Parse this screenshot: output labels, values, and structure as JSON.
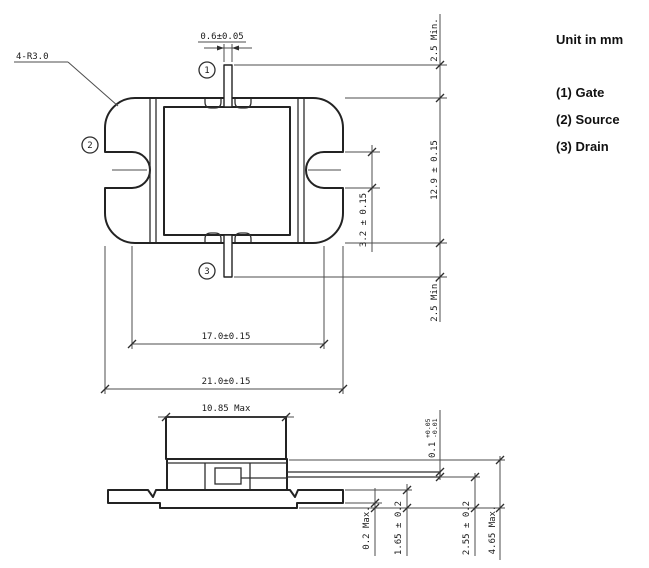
{
  "drawing": {
    "legend": {
      "unit_label": "Unit in mm",
      "pin_1": "(1) Gate",
      "pin_2": "(2) Source",
      "pin_3": "(3) Drain"
    },
    "markers": {
      "gate": "1",
      "source": "2",
      "drain": "3"
    },
    "top_view": {
      "corner_radius": "4-R3.0",
      "lead_width": "0.6±0.05",
      "gate_lead_min": "2.5 Min.",
      "body_height": "12.9 ± 0.15",
      "drain_lead_min": "2.5 Min.",
      "slot_width": "3.2 ± 0.15",
      "slot_pitch": "17.0±0.15",
      "body_width": "21.0±0.15"
    },
    "side_view": {
      "cap_width": "10.85 Max",
      "lead_thickness_base": "0.1",
      "lead_thickness_plus": "+0.05",
      "lead_thickness_minus": "-0.01",
      "standoff": "0.2 Max.",
      "flange_thickness": "1.65 ± 0.2",
      "lead_height": "2.55 ± 0.2",
      "total_height": "4.65 Max."
    },
    "colors": {
      "line": "#232323",
      "dimension": "#4d4d4d",
      "text": "#1a1a1a",
      "background": "#ffffff"
    }
  }
}
